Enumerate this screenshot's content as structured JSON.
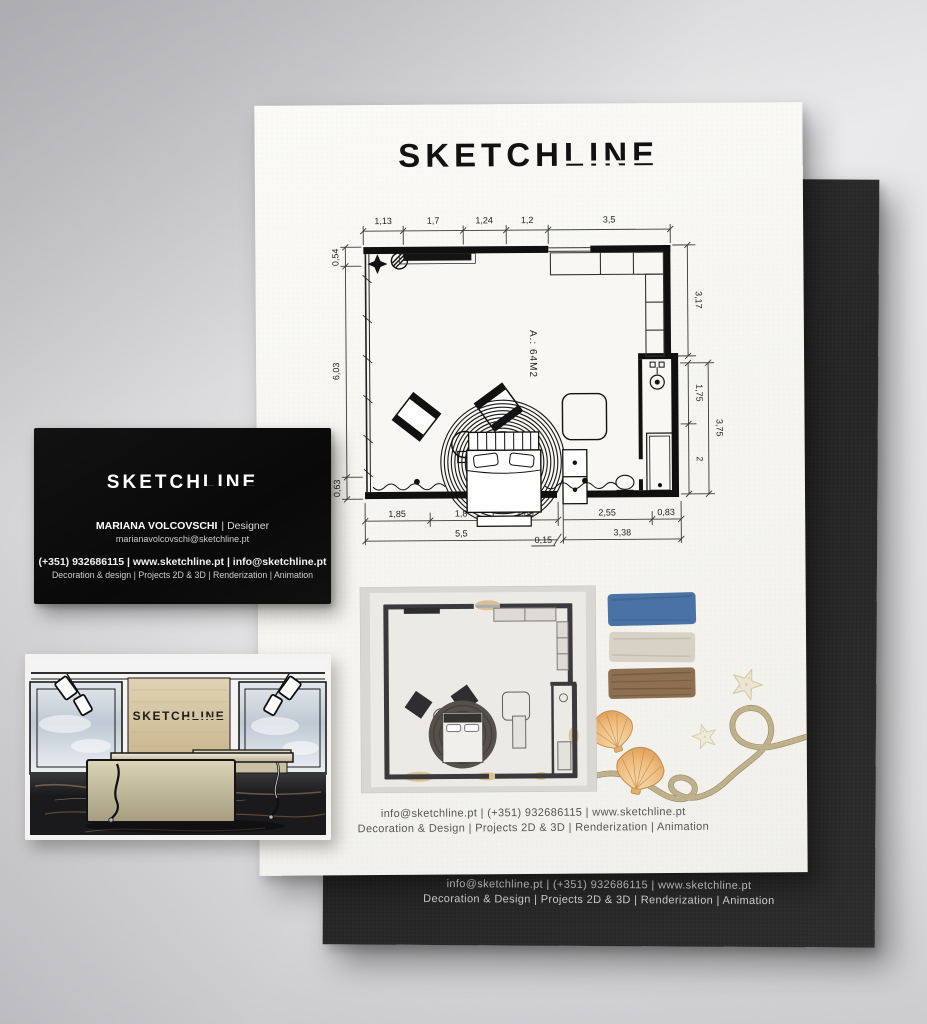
{
  "brand": {
    "logo_part1": "SKETCH",
    "logo_part2": "LINE",
    "full_name": "SKETCHLINE"
  },
  "poster": {
    "footer": {
      "line1": "info@sketchline.pt  |  (+351) 932686115  |  www.sketchline.pt",
      "line2": "Decoration & Design  |  Projects 2D & 3D  |  Renderization  |  Animation"
    }
  },
  "black_sheet": {
    "footer": {
      "line1": "info@sketchline.pt  |  (+351) 932686115  |  www.sketchline.pt",
      "line2": "Decoration & Design  |  Projects 2D & 3D  |  Renderization  |  Animation"
    }
  },
  "floor_plan": {
    "area_label": "A.: 64M2",
    "dims_top": [
      "1,13",
      "1,7",
      "1,24",
      "1,2",
      "3,5"
    ],
    "dims_left": [
      "0,54",
      "6,03",
      "0,63"
    ],
    "dims_right": {
      "top": "3,17",
      "middle": "1,75",
      "outer": "3,75",
      "bottom": "2"
    },
    "dims_bottom_row1": [
      "1,85",
      "1,8",
      "1,85",
      "2,55",
      "0,83"
    ],
    "dims_bottom_row2": [
      "5,5",
      "0,15",
      "3,38"
    ]
  },
  "business_card": {
    "logo_part1": "SKETCH",
    "logo_part2": "LINE",
    "name": "MARIANA VOLCOVSCHI",
    "role": "| Designer",
    "email": "marianavolcovschi@sketchline.pt",
    "contact_line": "(+351) 932686115 | www.sketchline.pt | info@sketchline.pt",
    "services_line": "Decoration & design | Projects 2D & 3D | Renderization | Animation"
  },
  "render_preview": {
    "wall_logo": "SKETCHLINE"
  },
  "moodboard": {
    "swatches": [
      {
        "name": "ocean-blue",
        "hex": "#4a72a4"
      },
      {
        "name": "shell-white",
        "hex": "#d8d2c6"
      },
      {
        "name": "driftwood-brown",
        "hex": "#8c7051"
      }
    ]
  }
}
